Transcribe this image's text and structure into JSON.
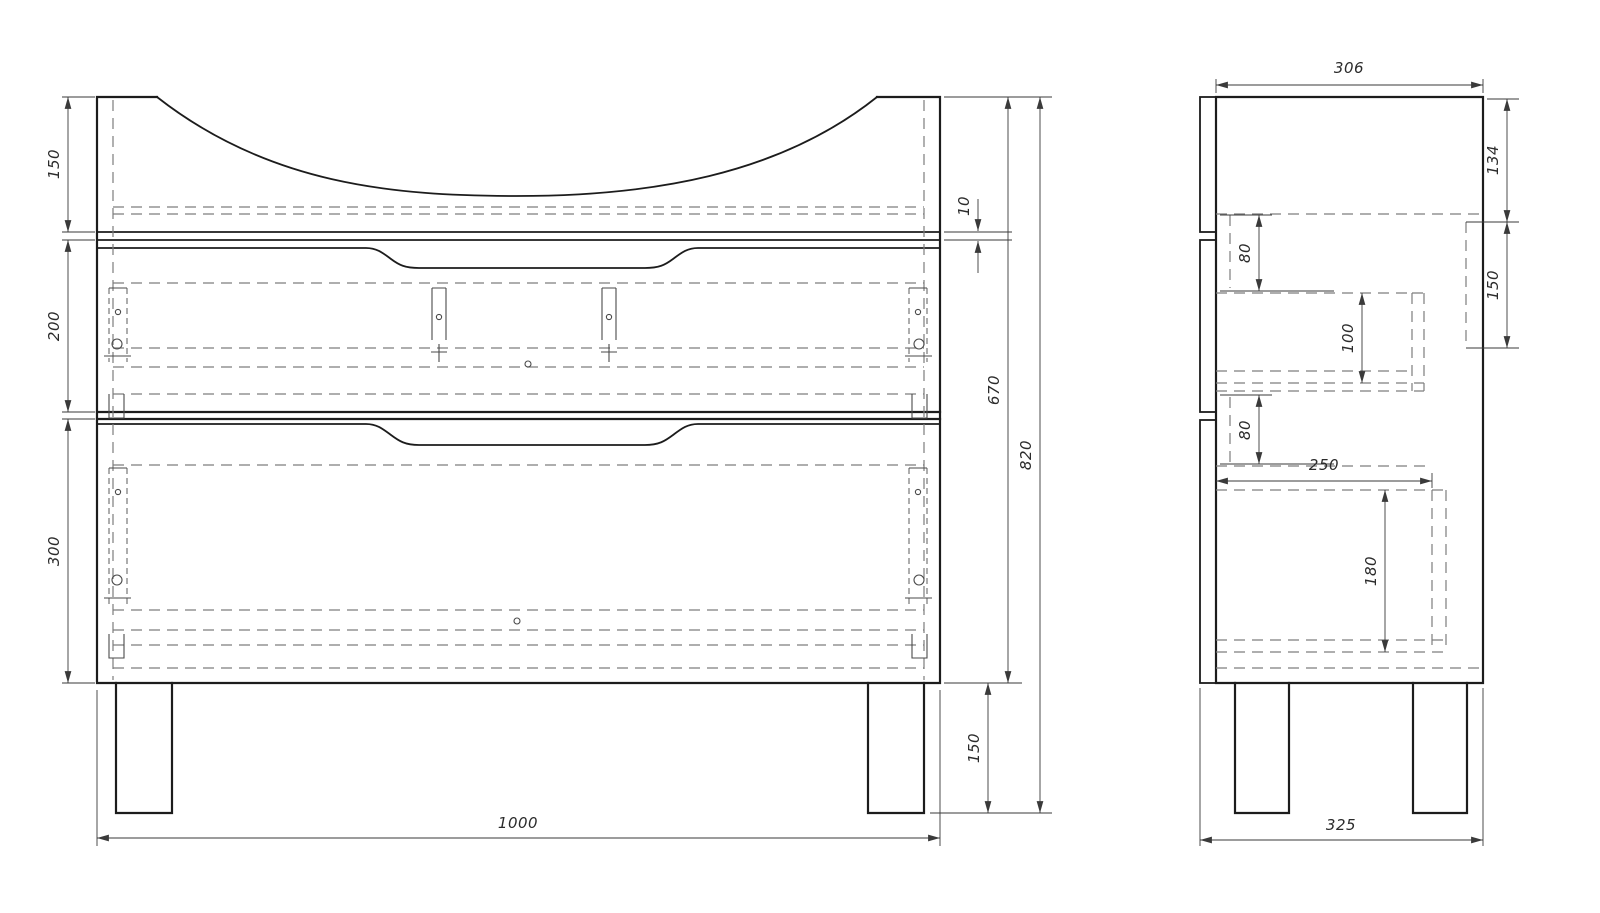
{
  "drawing": {
    "type": "furniture technical drawing",
    "subject": "bathroom vanity cabinet with two drawers and legs",
    "units": "mm"
  },
  "front_view": {
    "dims": {
      "top_section_height": "150",
      "drawer1_height": "200",
      "drawer2_height": "300",
      "top_gap": "10",
      "body_height": "670",
      "total_height": "820",
      "leg_height": "150",
      "width": "1000"
    }
  },
  "side_view": {
    "dims": {
      "depth_top": "306",
      "hanger_offset": "134",
      "hanger_height": "150",
      "drawer1_top_offset": "80",
      "drawer1_box_height": "100",
      "drawer2_top_offset": "80",
      "drawer2_box_depth": "250",
      "drawer2_box_height": "180",
      "depth_bottom": "325"
    }
  },
  "colors": {
    "background": "#ffffff",
    "outline": "#1c1c1c",
    "hidden_line": "#7d7d7d",
    "dimension_line": "#3a3a3a",
    "dimension_text": "#2b2b2b"
  }
}
